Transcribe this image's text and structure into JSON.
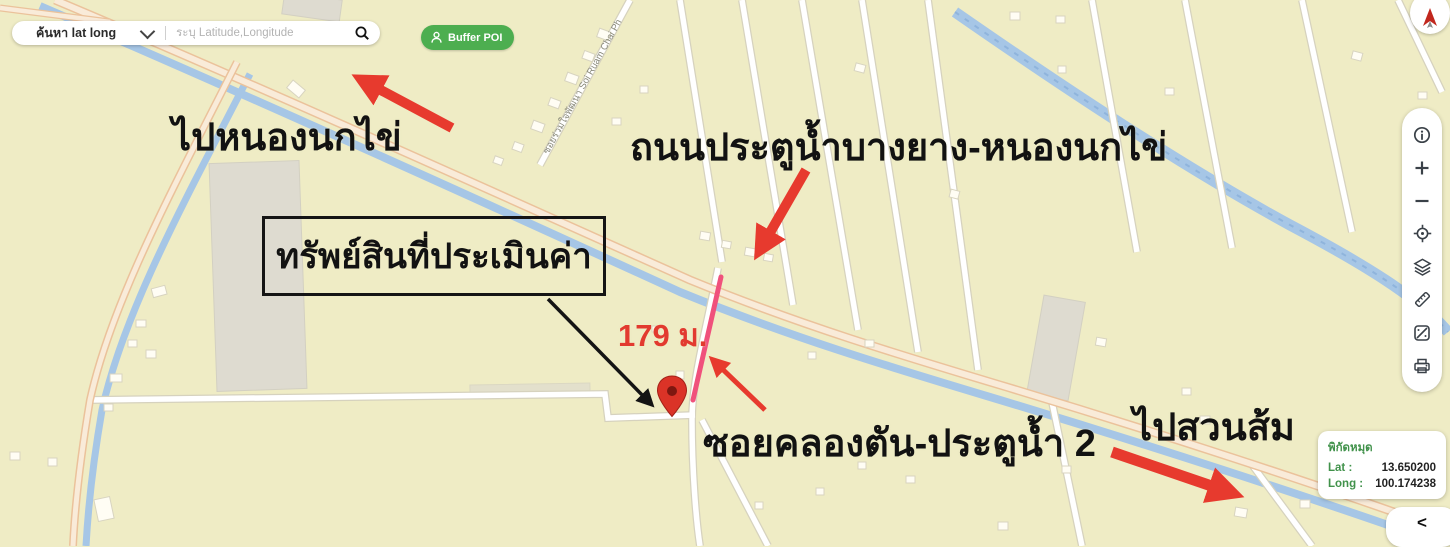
{
  "search": {
    "type_label": "ค้นหา lat long",
    "placeholder": "ระบุ Latitude,Longitude",
    "icons": [
      "chevron-down-icon",
      "search-icon"
    ]
  },
  "buffer_button": {
    "label": "Buffer POI",
    "icon": "person-pin-icon",
    "color": "#4DAE50"
  },
  "compass": {
    "icon": "north-arrow-icon"
  },
  "toolbar": {
    "items": [
      {
        "name": "info",
        "icon": "info-icon"
      },
      {
        "name": "zoom-in",
        "icon": "plus-icon"
      },
      {
        "name": "zoom-out",
        "icon": "minus-icon"
      },
      {
        "name": "locate",
        "icon": "crosshair-icon"
      },
      {
        "name": "layers",
        "icon": "layers-icon"
      },
      {
        "name": "measure",
        "icon": "ruler-icon"
      },
      {
        "name": "map-style",
        "icon": "map-diagonal-icon"
      },
      {
        "name": "print",
        "icon": "printer-icon"
      }
    ]
  },
  "coord_panel": {
    "title": "พิกัดหมุด",
    "lat_label": "Lat :",
    "lat_value": "13.650200",
    "long_label": "Long :",
    "long_value": "100.174238"
  },
  "collapse": {
    "label": "<"
  },
  "annotations": {
    "to_nong_nok_khai": "ไปหนองนกไข่",
    "main_road": "ถนนประตูน้ำบางยาง-หนองนกไข่",
    "property_box": "ทรัพย์สินที่ประเมินค่า",
    "distance": "179 ม.",
    "soi_label": "ซอยคลองตัน-ประตูน้ำ 2",
    "to_suan_som": "ไปสวนส้ม",
    "small_street": "ซอยร่วมใจพัฒนา Soi Ruam Chai Ph"
  },
  "colors": {
    "map_background": "#EFECC5",
    "canal_blue": "#A6C6E6",
    "road_fill": "#F9EBD9",
    "road_casing": "#EBC29B",
    "arrow_red": "#E73A2E",
    "highlight_pink": "#F0517C",
    "pin_red": "#DB3327",
    "panel_green": "#41924B",
    "button_green": "#4DAE50"
  }
}
